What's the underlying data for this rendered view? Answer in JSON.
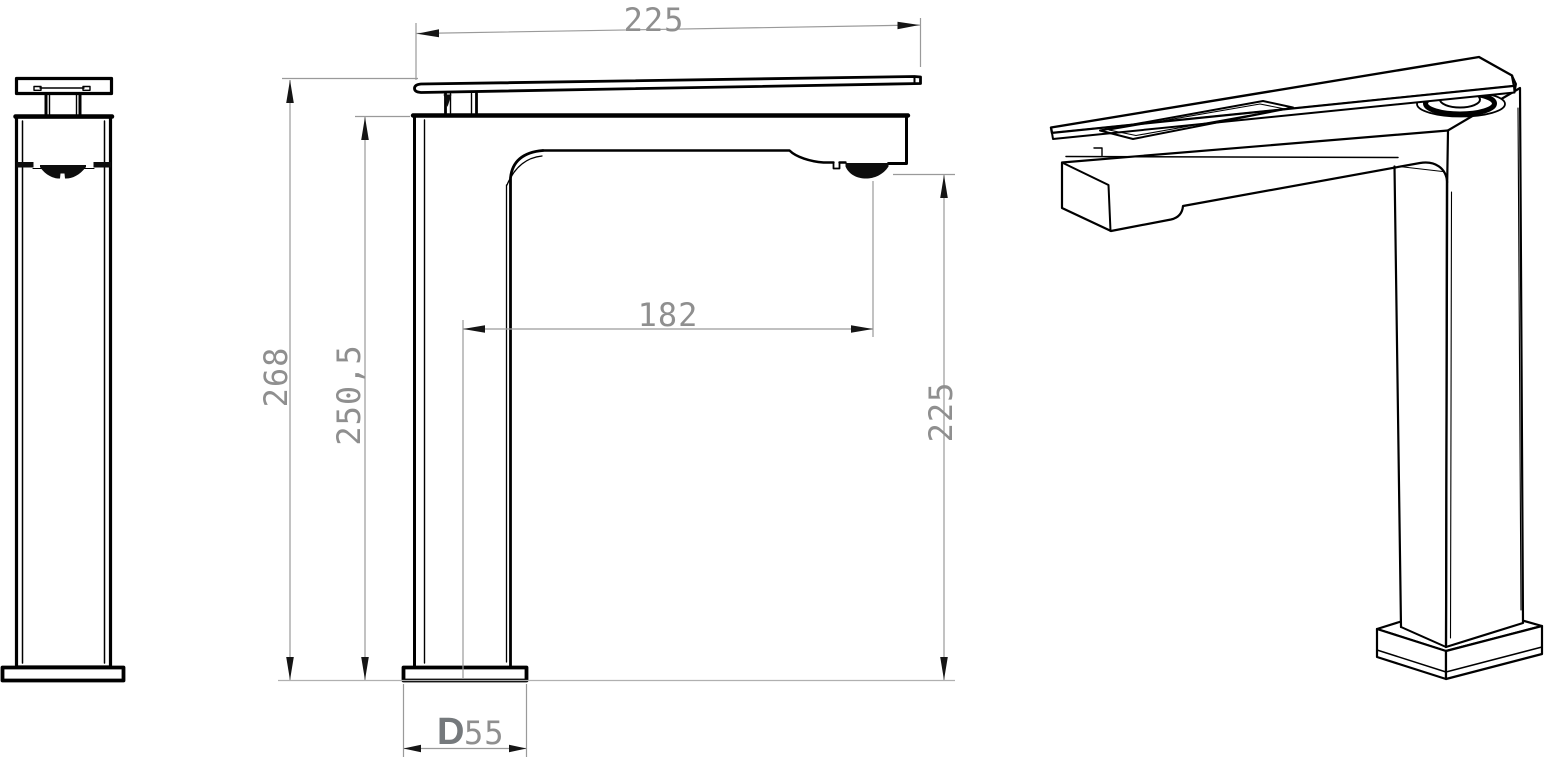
{
  "dimensions": {
    "handle_length": "225",
    "total_height": "268",
    "spout_top_height": "250,5",
    "spout_reach": "182",
    "spout_outlet_height": "225",
    "base_label_prefix": "D",
    "base_size": "55"
  },
  "colors": {
    "background": "#ffffff",
    "part_outline": "#000000",
    "dimension_line": "#9a9a9a",
    "arrowhead": "#151515",
    "dimension_text": "#8f8f8f",
    "base_label": "#75797c"
  }
}
